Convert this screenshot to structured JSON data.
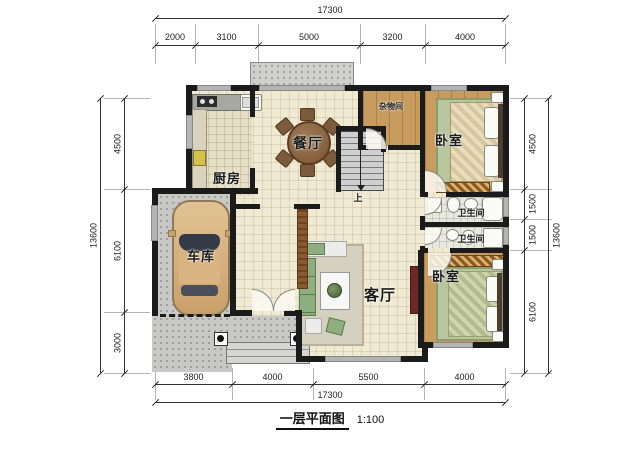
{
  "caption": {
    "title": "一层平面图",
    "scale": "1:100"
  },
  "dims": {
    "top_total": "17300",
    "top": [
      "2000",
      "3100",
      "5000",
      "3200",
      "4000"
    ],
    "bottom": [
      "3800",
      "4000",
      "5500",
      "4000"
    ],
    "bottom_total": "17300",
    "left": [
      "4500",
      "6100",
      "3000"
    ],
    "left_total": "13600",
    "right": [
      "4500",
      "1500",
      "1500",
      "6100"
    ],
    "right_total": "13600"
  },
  "rooms": {
    "kitchen": "厨房",
    "dining": "餐厅",
    "storage": "杂物间",
    "bedroom_top": "卧室",
    "bathroom_top": "卫生间",
    "bathroom_bottom": "卫生间",
    "living": "客厅",
    "garage": "车库",
    "bedroom_bottom": "卧室",
    "stairs_up": "上"
  },
  "colors": {
    "wall": "#1b1b1b",
    "tile_floor": "#f1ead2",
    "wood_floor": "#c89c5e",
    "concrete": "#c8c8c6",
    "window": "#b4b4b4",
    "rug_green": "#b8c69e"
  }
}
